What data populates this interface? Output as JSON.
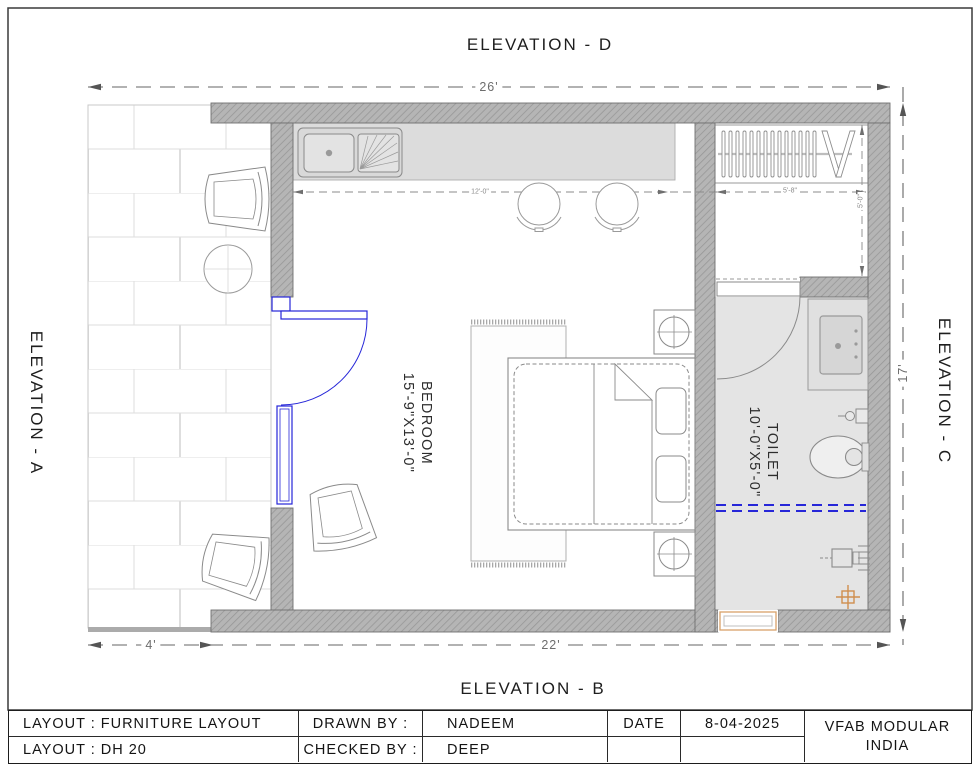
{
  "drawing": {
    "elevation_top": "ELEVATION - D",
    "elevation_bottom": "ELEVATION - B",
    "elevation_left": "ELEVATION - A",
    "elevation_right": "ELEVATION - C",
    "dim_overall_width": "26'",
    "dim_overall_height": "17'",
    "dim_balcony_width": "4'",
    "dim_room_width": "22'",
    "dim_counter_run": "12'-0\"",
    "dim_wardrobe_width": "5'-8\"",
    "dim_wardrobe_depth": "5'-0\"",
    "bedroom_name": "BEDROOM",
    "bedroom_size": "15'-9\"X13'-0\"",
    "toilet_name": "TOILET",
    "toilet_size": "10'-0\"X5'-0\""
  },
  "title_block": {
    "layout_label_1": "LAYOUT : FURNITURE LAYOUT",
    "layout_label_2": "LAYOUT : DH 20",
    "drawn_by_label": "DRAWN BY :",
    "drawn_by_value": "NADEEM",
    "checked_by_label": "CHECKED BY :",
    "checked_by_value": "DEEP",
    "date_label": "DATE",
    "date_value": "8-04-2025",
    "company_line_1": "VFAB MODULAR",
    "company_line_2": "INDIA"
  },
  "colors": {
    "wall_fill": "#b5b5b5",
    "wall_hatch": "#979797",
    "counter_fill": "#dcdcdc",
    "toilet_floor": "#e4e4e4",
    "door_blue": "#2626d8",
    "accent_tan": "#cf8e4e",
    "dim_gray": "#6d6d6d",
    "line_gray": "#8a8a8a"
  },
  "fixtures": [
    "kitchen-sink",
    "bar-stool",
    "bar-stool",
    "wardrobe",
    "balcony-chair",
    "round-table",
    "balcony-chair",
    "bedroom-chair",
    "entry-door",
    "rug",
    "double-bed",
    "nightstand",
    "nightstand",
    "toilet-door",
    "washbasin",
    "wc",
    "shower-screen",
    "shower-mixer",
    "floor-drain",
    "window"
  ]
}
